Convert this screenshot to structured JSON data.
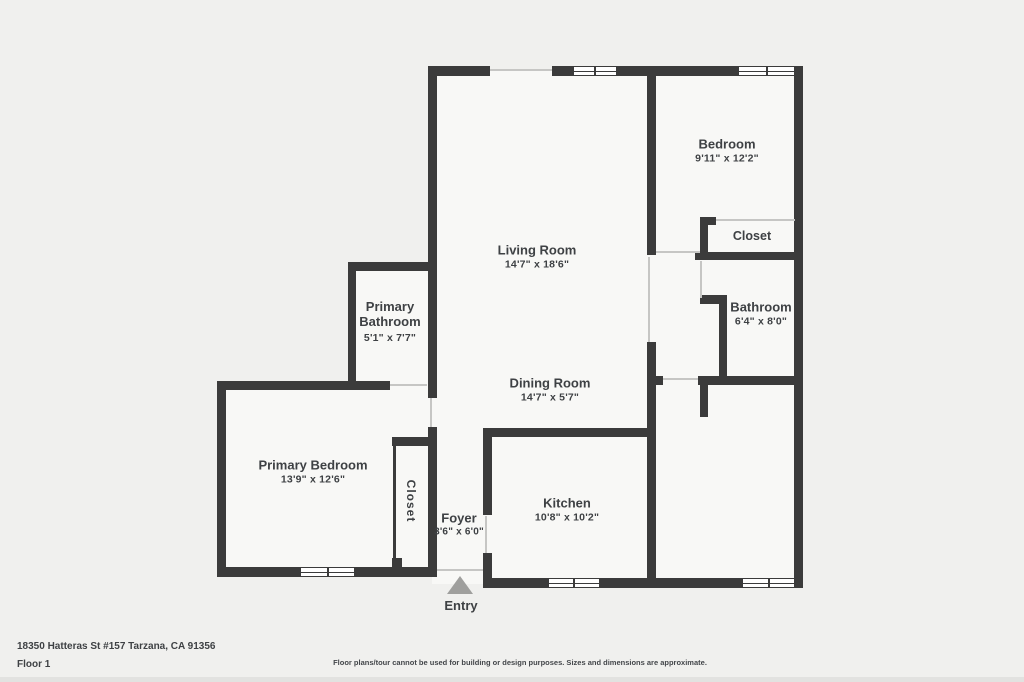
{
  "rooms": {
    "living": {
      "name": "Living Room",
      "dims": "14'7\" x 18'6\""
    },
    "bedroom1": {
      "name": "Bedroom",
      "dims": "9'11\" x 12'2\""
    },
    "closet1": {
      "name": "Closet"
    },
    "bathroom": {
      "name": "Bathroom",
      "dims": "6'4\" x 8'0\""
    },
    "primary_bathroom": {
      "name": "Primary Bathroom",
      "dims": "5'1\" x 7'7\""
    },
    "dining": {
      "name": "Dining Room",
      "dims": "14'7\" x 5'7\""
    },
    "primary_bedroom": {
      "name": "Primary Bedroom",
      "dims": "13'9\" x 12'6\""
    },
    "closet2": {
      "name": "Closet"
    },
    "foyer": {
      "name": "Foyer",
      "dims": "3'6\" x 6'0\""
    },
    "kitchen": {
      "name": "Kitchen",
      "dims": "10'8\" x 10'2\""
    },
    "bedroom2": {
      "name": "Bedroom",
      "dims": "9'11\" x 13'9\""
    }
  },
  "entry": {
    "label": "Entry"
  },
  "footer": {
    "address": "18350 Hatteras St #157 Tarzana, CA 91356",
    "floor": "Floor 1",
    "disclaimer": "Floor plans/tour cannot be used for building or design purposes. Sizes and dimensions are approximate."
  },
  "colors": {
    "wall": "#3b3b3b",
    "bg": "#f0f0ee",
    "floor": "#f8f8f6",
    "opening": "#c6c6c4",
    "text": "#3e4144",
    "arrow": "#9f9f9d"
  }
}
